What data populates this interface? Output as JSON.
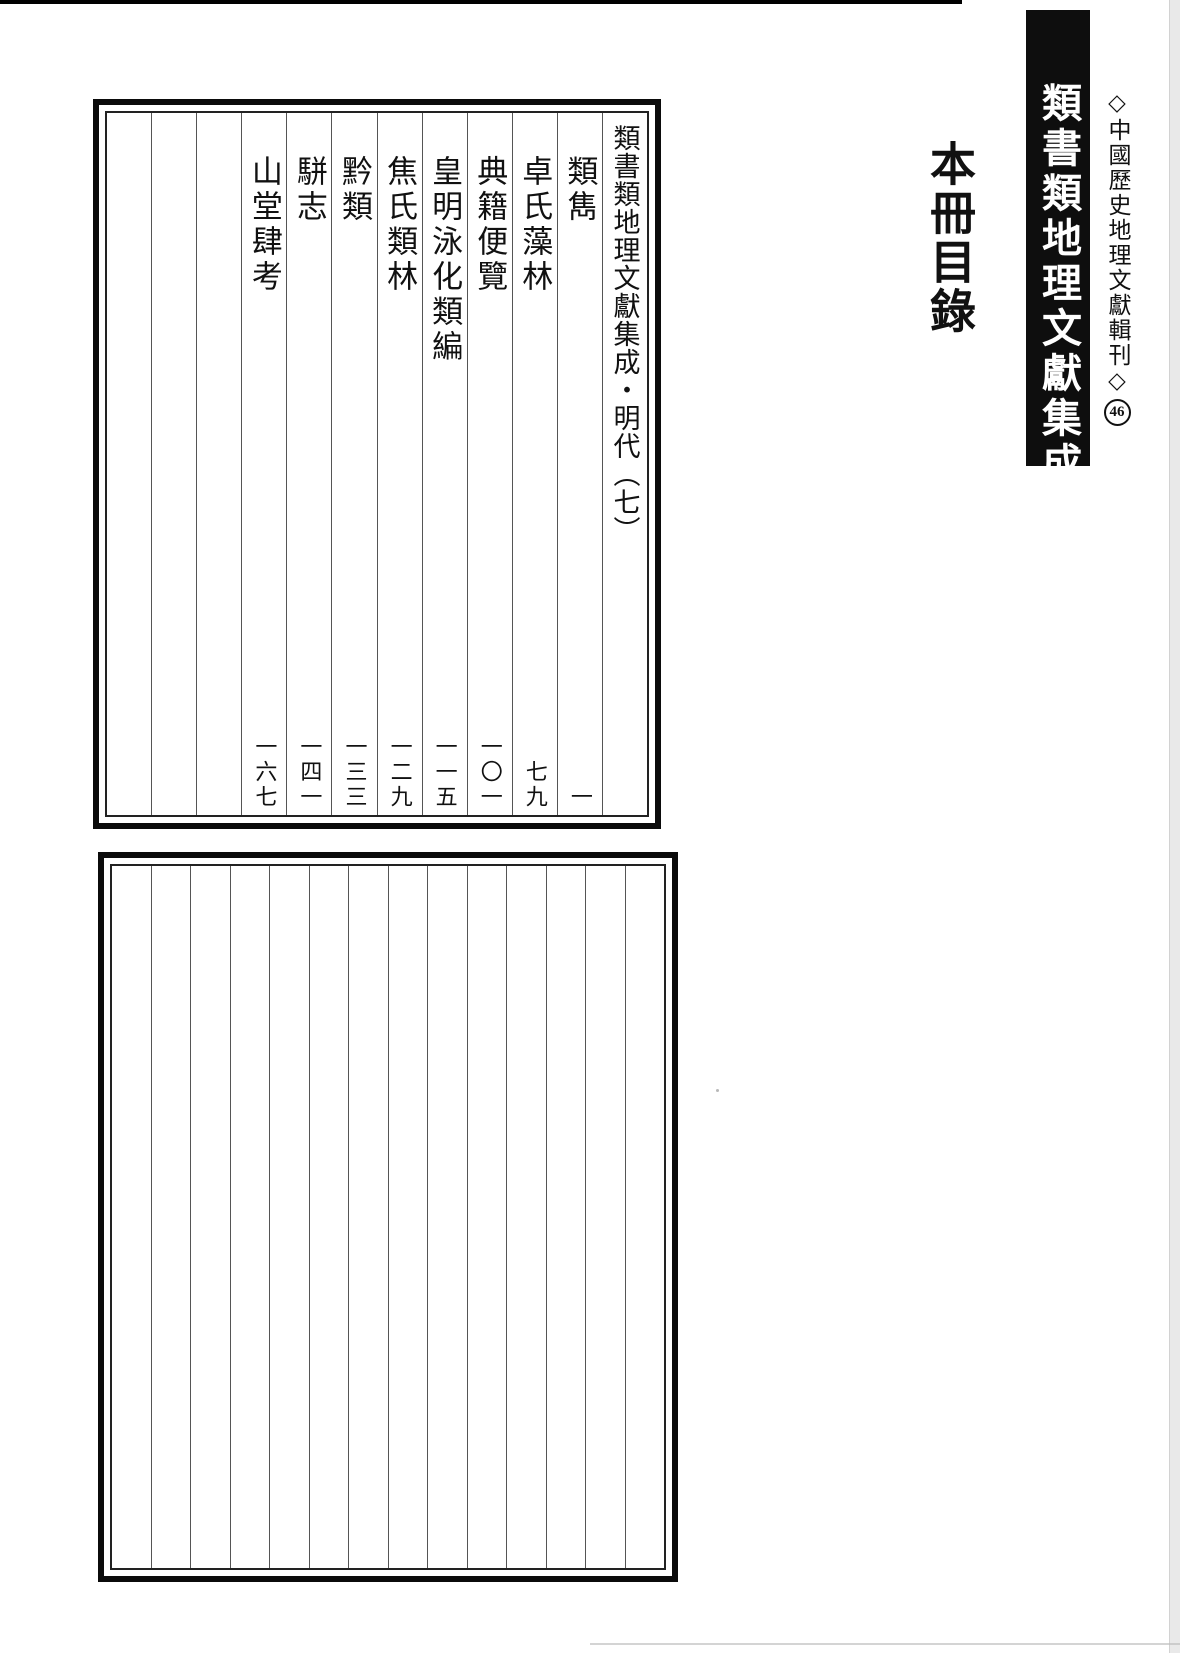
{
  "banner": {
    "title": "類書類地理文獻集成"
  },
  "series": {
    "label": "◇中國歷史地理文獻輯刊◇",
    "volume_number": "46"
  },
  "heading": {
    "title": "本冊目錄"
  },
  "toc": {
    "header": "類書類地理文獻集成・明代（七）",
    "entries": [
      {
        "title": "類雋",
        "page": "一"
      },
      {
        "title": "卓氏藻林",
        "page": "七九"
      },
      {
        "title": "典籍便覽",
        "page": "一〇一"
      },
      {
        "title": "皇明泳化類編",
        "page": "一一五"
      },
      {
        "title": "焦氏類林",
        "page": "一二九"
      },
      {
        "title": "黔類",
        "page": "一三三"
      },
      {
        "title": "駢志",
        "page": "一四一"
      },
      {
        "title": "山堂肆考",
        "page": "一六七"
      }
    ],
    "empty_columns": 3
  },
  "blank_box": {
    "columns": 14
  },
  "colors": {
    "paper": "#ffffff",
    "ink": "#111111",
    "banner_bg": "#0e0e0e",
    "column_divider": "#555555"
  }
}
